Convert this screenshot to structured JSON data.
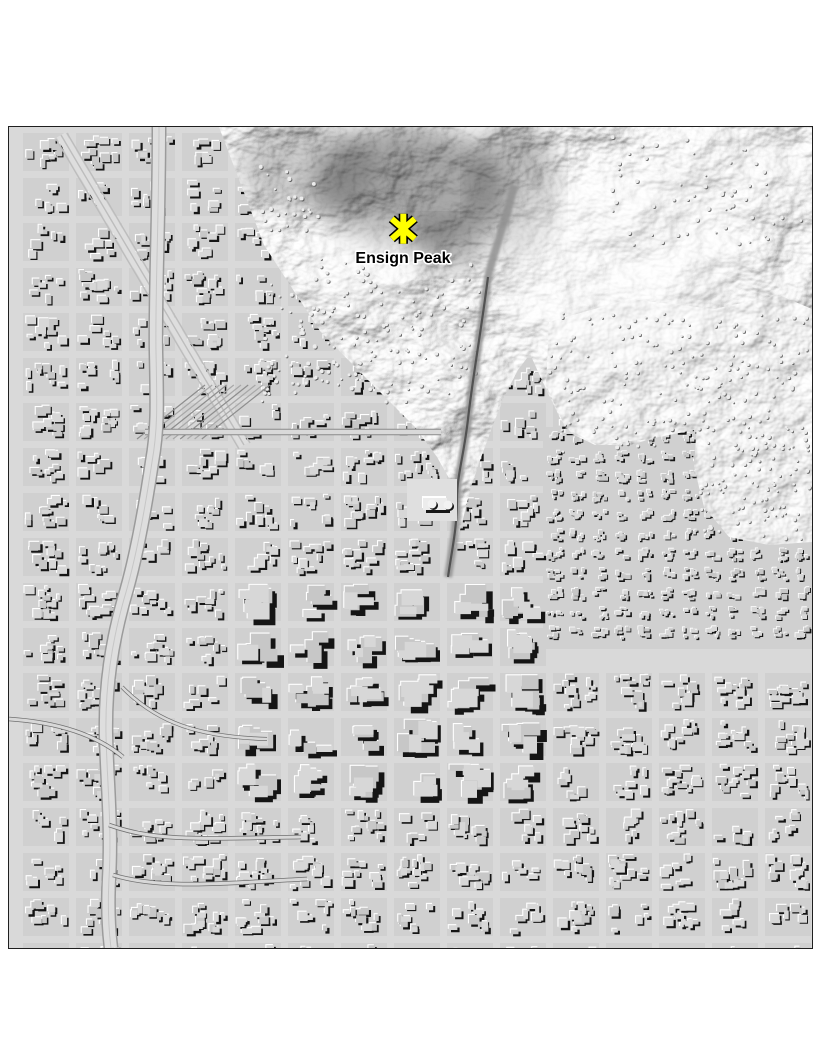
{
  "page": {
    "background_color": "#ffffff"
  },
  "map": {
    "kind": "hillshade relief map",
    "palette": {
      "base": "#d8d8d8",
      "street": "#d9d9d9",
      "block": "#d0d0d0",
      "building_top_a": "#c7c7c7",
      "building_top_b": "#d7d7d7",
      "shadow": "#151515",
      "highlight": "#ffffff",
      "border": "#1f1f1f"
    },
    "marker": {
      "label": "Ensign Peak",
      "symbol": "asterisk",
      "fill": "#ffff00",
      "outline": "#000000",
      "label_color": "#000000",
      "label_halo": "#ffffff",
      "x_pct": 49.1,
      "y_pct": 12.4
    }
  }
}
